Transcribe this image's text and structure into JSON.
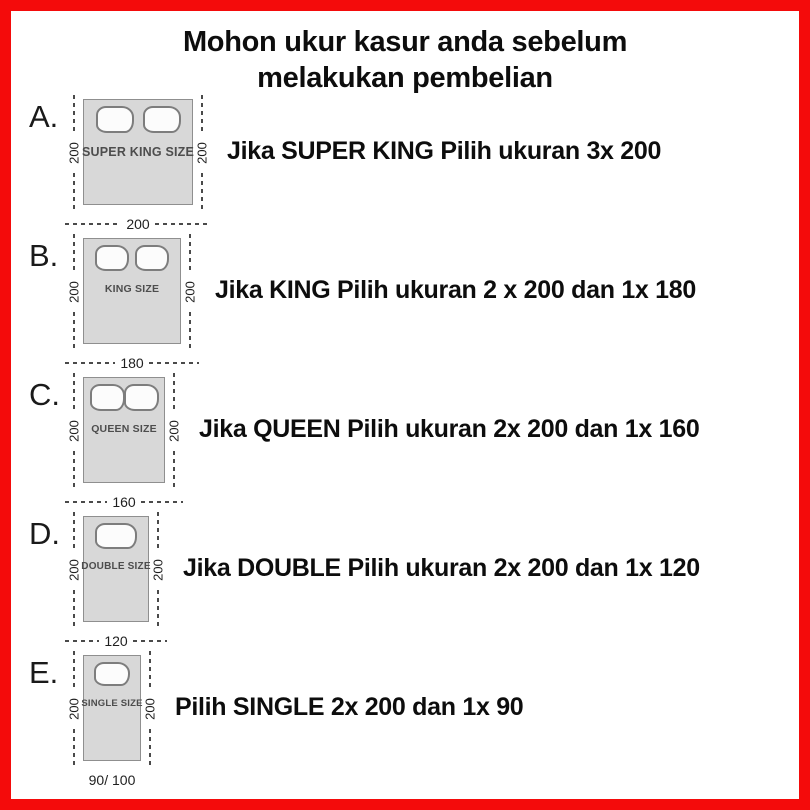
{
  "colors": {
    "border": "#f40b0b",
    "mattress": "#d8d8d8",
    "dimension_line": "#4a4a4a"
  },
  "title": {
    "line1": "Mohon ukur kasur anda sebelum",
    "line2": "melakukan pembelian"
  },
  "rows": [
    {
      "letter": "A.",
      "bed_label": "SUPER KING SIZE",
      "left_dim": "200",
      "right_dim": "200",
      "bottom_dim": "200",
      "caption": "Jika SUPER KING Pilih ukuran 3x 200"
    },
    {
      "letter": "B.",
      "bed_label": "KING SIZE",
      "left_dim": "200",
      "right_dim": "200",
      "bottom_dim": "180",
      "caption": "Jika KING Pilih ukuran 2 x 200 dan 1x 180"
    },
    {
      "letter": "C.",
      "bed_label": "QUEEN SIZE",
      "left_dim": "200",
      "right_dim": "200",
      "bottom_dim": "160",
      "caption": "Jika QUEEN Pilih ukuran 2x 200 dan 1x 160"
    },
    {
      "letter": "D.",
      "bed_label": "DOUBLE SIZE",
      "left_dim": "200",
      "right_dim": "200",
      "bottom_dim": "120",
      "caption": "Jika DOUBLE Pilih ukuran 2x 200 dan 1x 120"
    },
    {
      "letter": "E.",
      "bed_label": "SINGLE SIZE",
      "left_dim": "200",
      "right_dim": "200",
      "bottom_dim": "90/ 100",
      "caption": "Pilih SINGLE 2x 200 dan 1x 90"
    }
  ]
}
